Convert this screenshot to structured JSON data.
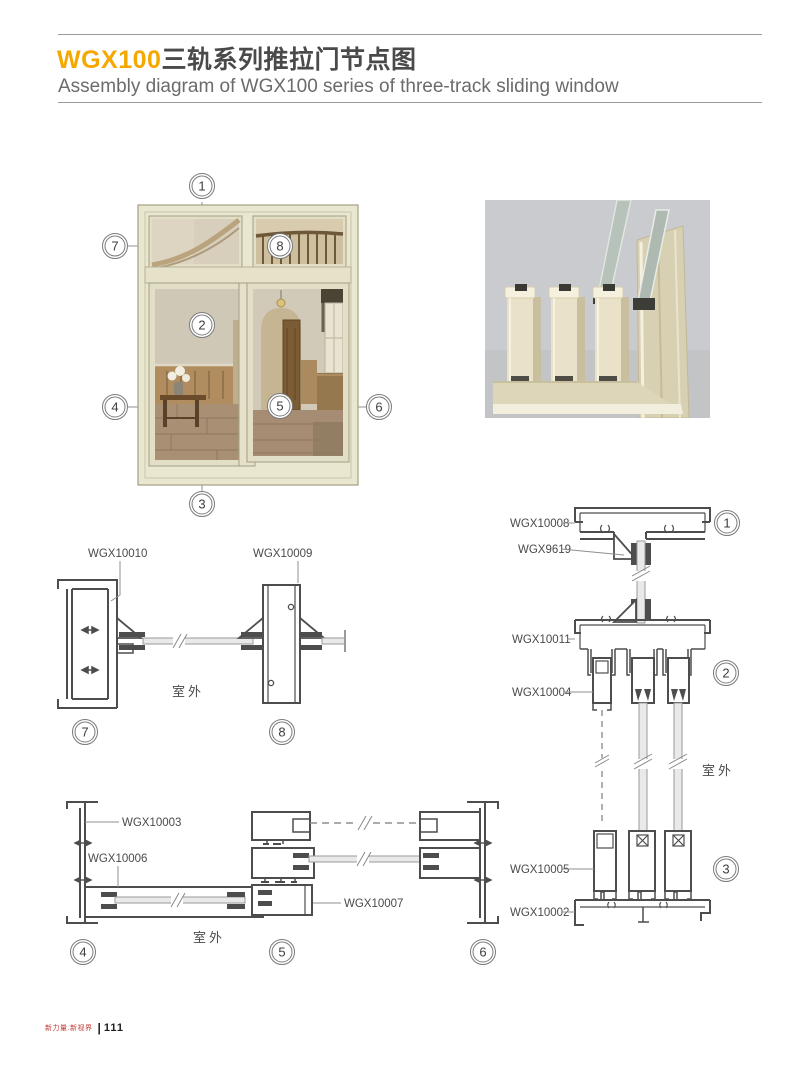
{
  "header": {
    "title_code": "WGX100",
    "title_cn": "三轨系列推拉门节点图",
    "subtitle": "Assembly diagram of WGX100 series of three-track sliding window",
    "accent_color": "#F5A800",
    "title_color": "#4A4A4A"
  },
  "callouts": {
    "c1": "1",
    "c2": "2",
    "c3": "3",
    "c4": "4",
    "c5": "5",
    "c6": "6",
    "c7": "7",
    "c8": "8"
  },
  "parts": {
    "wgx10010": "WGX10010",
    "wgx10009": "WGX10009",
    "wgx10008": "WGX10008",
    "wgx9619": "WGX9619",
    "wgx10011": "WGX10011",
    "wgx10004": "WGX10004",
    "wgx10005": "WGX10005",
    "wgx10002": "WGX10002",
    "wgx10003": "WGX10003",
    "wgx10006": "WGX10006",
    "wgx10007": "WGX10007"
  },
  "labels": {
    "outdoor": "室外"
  },
  "drawing_colors": {
    "profile_stroke": "#4d4d4d",
    "glass_fill": "#e9e9e9",
    "glass_stroke": "#9a9a9a",
    "leader": "#8f8f8f",
    "hatch": "#4d4d4d",
    "window_frame": "#EAE7D1",
    "render_bg": "#C9CBCE"
  },
  "footer": {
    "brand": "新力量.新视界",
    "page_number": "111"
  }
}
